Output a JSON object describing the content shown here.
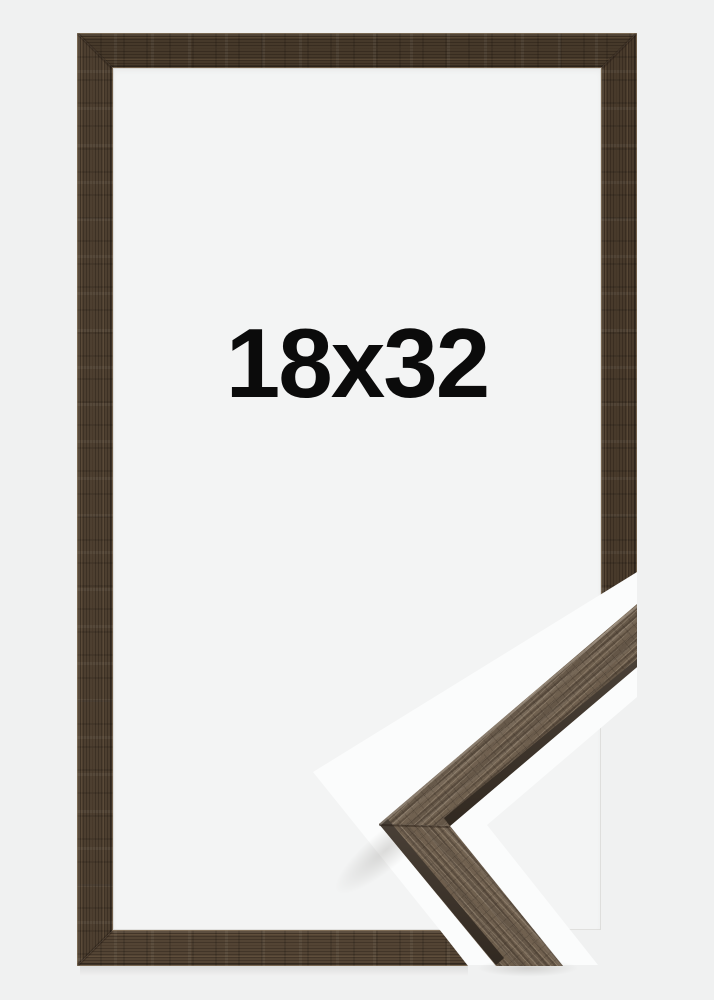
{
  "product": {
    "size_label": "18x32"
  },
  "colors": {
    "background": "#f0f1f1",
    "frame_opening": "#f3f4f4",
    "cutout_white": "#fbfcfc",
    "wood_main": "#4a3c2d",
    "wood_sample": "#6f5e4b",
    "wood_edge_dark": "#3a3026",
    "label_text": "#0b0b0b"
  }
}
